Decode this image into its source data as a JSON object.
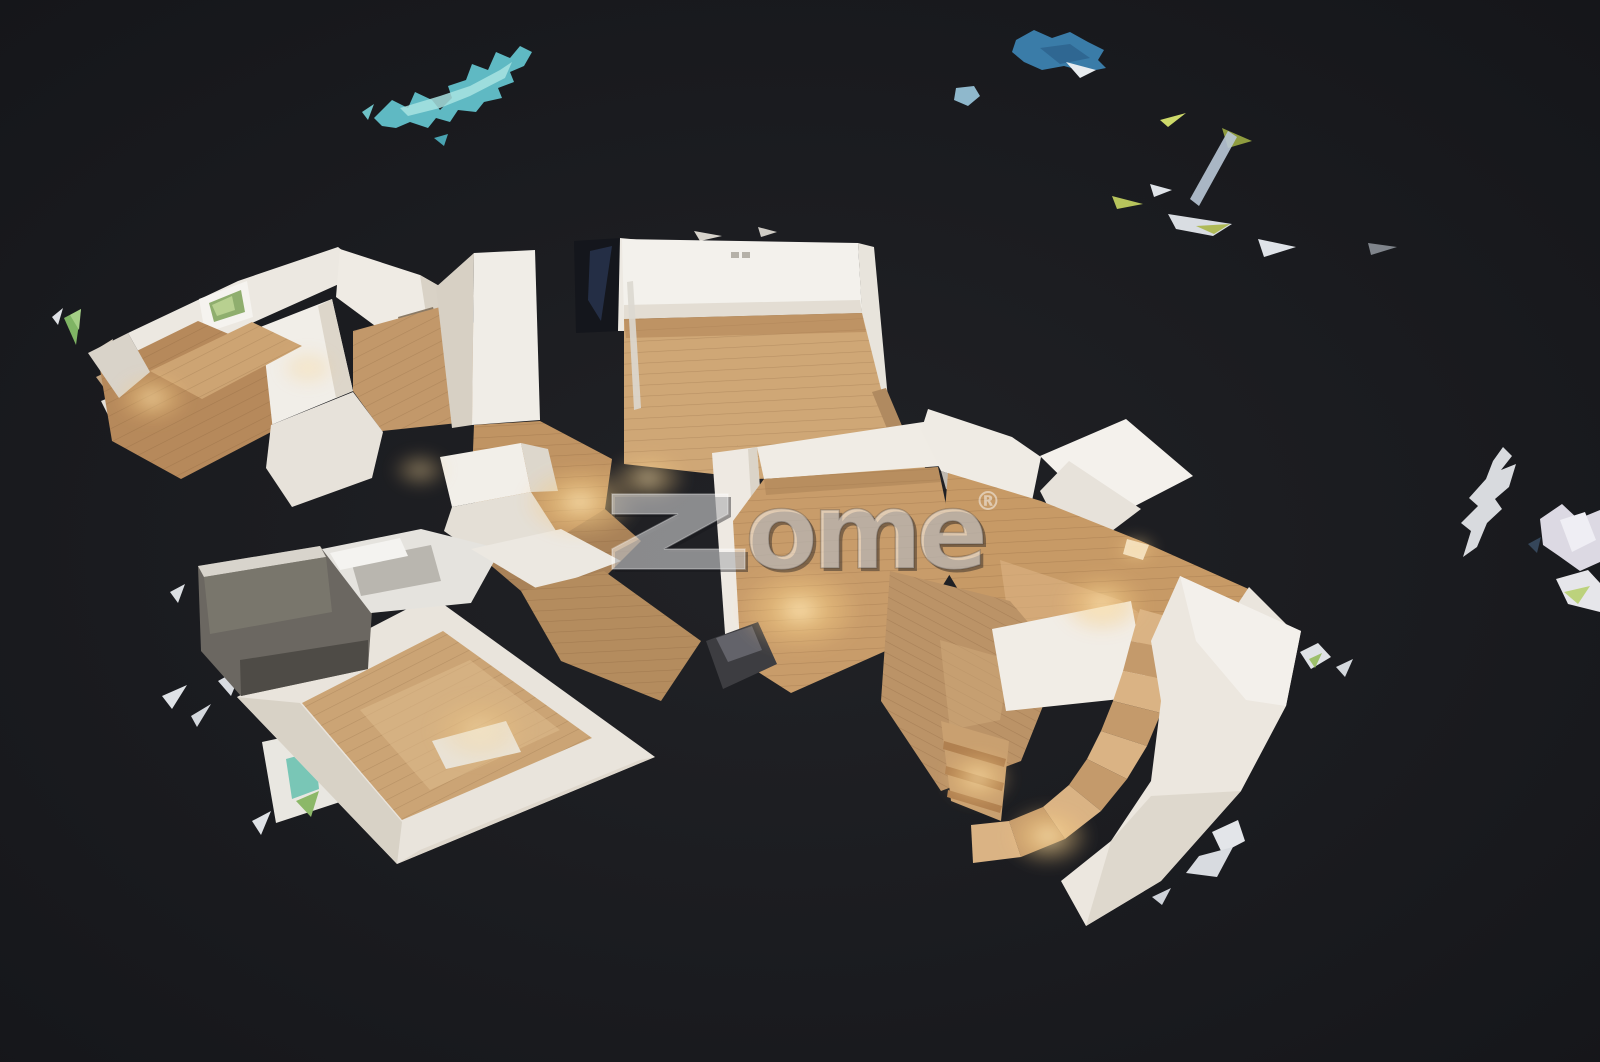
{
  "canvas": {
    "width": 1600,
    "height": 1062
  },
  "palette": {
    "background_center": "#212226",
    "background_edge": "#141519",
    "wall_light": "#f3f1ec",
    "wall": "#ece8e1",
    "wall_shade": "#d9d2c6",
    "wood_light": "#dcb688",
    "wood": "#c79e6c",
    "wood_dark": "#aa835a",
    "teal_fragment": "#5fb9c3",
    "blue_fragment": "#3a7ca8",
    "green_fragment": "#7fb464",
    "lamp_glow": "#ffe9b8",
    "watermark_fill": "rgba(250,250,250,0.5)",
    "watermark_shadow": "rgba(22,22,26,0.42)"
  },
  "watermark": {
    "brand": "zome®",
    "rest": "ome",
    "reg": "®",
    "z_points": "612,494 728,494 728,514 664,549 745,549 745,569 612,569 612,549 678,514 612,514"
  },
  "scene": {
    "shapes": [
      {
        "n": "teal-ceiling-fragment",
        "p": "374,118 392,100 408,108 415,92 432,100 440,110 452,98 448,86 466,80 472,64 488,70 496,52 510,58 520,46 532,52 524,66 510,72 514,82 498,88 502,98 484,102 476,112 458,110 450,122 436,118 428,128 410,122 396,128 382,126",
        "f": "#5fb9c3"
      },
      {
        "n": "teal-ceiling-fragment-highlight",
        "p": "400,108 440,96 470,86 500,70 512,62 505,78 470,96 440,108 408,116",
        "f": "#a8e3e2",
        "o": 0.85
      },
      {
        "n": "teal-fragment-dot",
        "p": "434,138 448,134 444,146",
        "f": "#4aa4b2"
      },
      {
        "n": "teal-fragment-sliver",
        "p": "362,112 374,104 368,120",
        "f": "#6fc2c8"
      },
      {
        "n": "blue-ceiling-fragment",
        "p": "1016,40 1034,30 1052,38 1070,32 1088,42 1104,50 1098,60 1106,68 1086,72 1064,66 1042,70 1024,62 1012,52",
        "f": "#3a7ca8"
      },
      {
        "n": "blue-ceiling-fragment-shade",
        "p": "1040,48 1070,44 1090,58 1060,64",
        "f": "#2d618c",
        "o": 0.8
      },
      {
        "n": "blue-fragment-white-corner",
        "p": "1066,62 1096,70 1080,78",
        "f": "#e8ecef"
      },
      {
        "n": "blue-fragment-small",
        "p": "956,88 974,86 980,96 968,106 954,100",
        "f": "#8fb8cc"
      },
      {
        "n": "shard-sliver",
        "p": "1160,120 1186,113 1168,127",
        "f": "#cdd96a"
      },
      {
        "n": "shard-sliver",
        "p": "1222,128 1252,141 1228,148",
        "f": "#8f9c3f"
      },
      {
        "n": "shard-sliver",
        "p": "1228,131 1237,137 1199,206 1190,199",
        "f": "#b9c8d6",
        "o": 0.9
      },
      {
        "n": "shard-sliver",
        "p": "1150,184 1172,190 1154,197",
        "f": "#dfe3e8"
      },
      {
        "n": "shard-sliver",
        "p": "1112,196 1143,204 1117,209",
        "f": "#b7c45c"
      },
      {
        "n": "shard-sliver",
        "p": "1168,214 1232,224 1213,236 1176,229",
        "f": "#d9dde2"
      },
      {
        "n": "shard-sliver",
        "p": "1196,226 1230,224 1214,234",
        "f": "#aab648",
        "o": 0.9
      },
      {
        "n": "shard-sliver",
        "p": "1258,239 1296,247 1264,257",
        "f": "#dfe3e8"
      },
      {
        "n": "shard-sliver",
        "p": "1368,243 1397,247 1371,255",
        "f": "#9aa0a8",
        "o": 0.8
      },
      {
        "n": "right-edge-shard",
        "p": "1493,461 1503,447 1512,456 1501,470 1516,464 1509,487 1495,499 1502,509 1487,523 1477,547 1463,557 1471,531 1461,523 1478,506 1469,498 1486,479",
        "f": "#d8dade"
      },
      {
        "n": "right-edge-shard",
        "p": "1540,519 1562,504 1578,519 1600,510 1600,562 1580,571 1559,556 1543,545",
        "f": "#dcd9e3"
      },
      {
        "n": "right-edge-shard-highlight",
        "p": "1560,520 1585,512 1596,540 1572,552",
        "f": "#efeef4"
      },
      {
        "n": "right-edge-shard",
        "p": "1556,579 1588,570 1600,583 1600,612 1568,604",
        "f": "#e6e6ea"
      },
      {
        "n": "right-edge-shard-green",
        "p": "1564,592 1590,586 1578,604",
        "f": "#bcd27c"
      },
      {
        "n": "right-edge-shard-dark",
        "p": "1528,544 1541,537 1537,553",
        "f": "#35465a"
      },
      {
        "n": "right-lower-shard",
        "p": "1300,652 1318,643 1331,657 1311,669",
        "f": "#dfe2e6"
      },
      {
        "n": "right-lower-shard-green",
        "p": "1309,659 1322,653 1315,668",
        "f": "#9cbf6a"
      },
      {
        "n": "right-lower-shard",
        "p": "1336,667 1353,659 1345,677",
        "f": "#d4d8dd"
      },
      {
        "n": "bottom-right-shard",
        "p": "1212,832 1238,820 1245,841 1222,853",
        "f": "#e3e5e9"
      },
      {
        "n": "bottom-right-shard",
        "p": "1199,856 1233,847 1217,877 1186,873",
        "f": "#d8dbe0"
      },
      {
        "n": "bottom-right-shard",
        "p": "1152,897 1171,888 1162,905",
        "f": "#cfd3d9"
      },
      {
        "n": "left-edge-shard-green",
        "p": "64,318 81,309 76,345",
        "f": "#7fb464"
      },
      {
        "n": "left-edge-shard-green-highlight",
        "p": "70,315 81,309 79,330",
        "f": "#a5cf86"
      },
      {
        "n": "left-edge-shard",
        "p": "52,317 63,308 58,325",
        "f": "#dfe2e6"
      },
      {
        "n": "left-edge-shard",
        "p": "92,352 113,339 106,369",
        "f": "#d9cdbd"
      },
      {
        "n": "left-edge-shard",
        "p": "96,377 119,366 108,393",
        "f": "#c2a37f"
      },
      {
        "n": "left-edge-shard",
        "p": "101,401 123,392 110,419",
        "f": "#e4e0d8"
      },
      {
        "n": "left-edge-shard",
        "p": "138,433 156,424 148,446",
        "f": "#cbb193"
      },
      {
        "n": "left-shard",
        "p": "170,592 185,584 178,603",
        "f": "#dcdfe3"
      },
      {
        "n": "left-shard",
        "p": "162,696 187,685 172,709",
        "f": "#dfe2e6"
      },
      {
        "n": "left-shard",
        "p": "191,716 211,704 197,727",
        "f": "#d4d8dd"
      },
      {
        "n": "left-shard",
        "p": "218,681 243,667 231,696",
        "f": "#d9dce1"
      },
      {
        "n": "mirror-fragment-frame",
        "p": "262,742 331,727 343,801 276,823",
        "f": "#e9e7e1"
      },
      {
        "n": "mirror-fragment-glass-teal",
        "p": "286,759 315,751 319,789 292,799",
        "f": "#79c6b6"
      },
      {
        "n": "mirror-fragment-glass-green",
        "p": "296,801 319,791 311,817",
        "f": "#8cb868"
      },
      {
        "n": "mirror-fragment-chip",
        "p": "252,821 271,811 261,835",
        "f": "#dfe2e6"
      },
      {
        "n": "bedroom-back-wall",
        "p": "128,333 238,281 338,247 368,271 252,323 150,372",
        "f": "#ece8e1"
      },
      {
        "n": "bedroom-window-frame",
        "p": "199,299 247,281 253,317 205,333",
        "f": "#f5f3ef"
      },
      {
        "n": "bedroom-window-glass",
        "p": "209,303 241,290 245,312 214,322",
        "f": "#8fae6e"
      },
      {
        "n": "bedroom-window-glass-highlight",
        "p": "212,305 232,296 235,310 217,316",
        "f": "#bcd494",
        "o": 0.9
      },
      {
        "n": "bedroom-right-wing-wall",
        "p": "340,249 420,275 462,299 458,349 382,331 336,297",
        "f": "#efebe4"
      },
      {
        "n": "bedroom-right-wing-shade",
        "p": "420,275 462,299 458,349 430,340",
        "f": "#d9d2c6"
      },
      {
        "n": "bedroom-mid-wall",
        "p": "250,331 332,299 353,391 271,425",
        "f": "#f1eee8"
      },
      {
        "n": "bedroom-mid-wall-shade",
        "p": "332,299 353,391 336,398 318,306",
        "f": "#ddd6ca"
      },
      {
        "n": "bedroom-floor-left",
        "p": "100,369 198,321 264,349 273,431 181,479 112,441",
        "f": "#b6895b",
        "pat": "pd2"
      },
      {
        "n": "bedroom-floor-strip",
        "p": "150,371 252,322 302,346 202,399",
        "f": "#cda473",
        "pat": "pd2"
      },
      {
        "n": "bedroom-door-dark",
        "p": "398,317 433,307 441,337 406,349",
        "f": "#8a7a66"
      },
      {
        "n": "bedroom-door-dark-inner",
        "p": "404,321 426,314 432,334 412,342",
        "f": "#5f5244"
      },
      {
        "n": "hall-floor-upper",
        "p": "353,331 462,301 487,349 477,421 382,431 353,391",
        "f": "#c2986a",
        "pat": "pd2"
      },
      {
        "n": "bedroom-lower-wall",
        "p": "271,425 353,392 383,432 372,478 292,507 266,468",
        "f": "#e7e2da"
      },
      {
        "n": "bedroom-outer-sliver",
        "p": "88,353 128,333 150,372 119,398",
        "f": "#d9d3c9"
      },
      {
        "n": "kitchen-left-wall-shade",
        "p": "436,287 474,253 472,425 452,428",
        "f": "#d7d0c4"
      },
      {
        "n": "kitchen-left-wall",
        "p": "474,253 535,250 540,420 472,425",
        "f": "#f0ede7"
      },
      {
        "n": "dark-doorway",
        "p": "574,241 622,238 620,331 576,333",
        "f": "#14161c"
      },
      {
        "n": "dark-doorway-stairs",
        "p": "590,251 612,246 601,321 588,300",
        "f": "#26314a",
        "o": 0.9
      },
      {
        "n": "doorway-right-jamb",
        "p": "620,238 641,240 639,331 618,331",
        "f": "#ede9e2"
      },
      {
        "n": "top-wall-sliver",
        "p": "694,231 722,236 700,241",
        "f": "#d8d4cc"
      },
      {
        "n": "top-wall-sliver",
        "p": "758,227 777,232 761,237",
        "f": "#cfccc5"
      },
      {
        "n": "living-room-top-wall",
        "p": "622,239 858,243 862,313 624,319",
        "f": "#f3f1ec"
      },
      {
        "n": "living-room-baseboard-shade",
        "p": "624,305 860,300 862,313 624,319",
        "f": "#ded8cd",
        "o": 0.8
      },
      {
        "n": "wall-socket",
        "p": "731,252 739,252 739,258 731,258",
        "f": "#b5b1a8"
      },
      {
        "n": "wall-socket",
        "p": "742,252 750,252 750,258 742,258",
        "f": "#b5b1a8"
      },
      {
        "n": "living-room-right-wall",
        "p": "858,243 874,247 890,421 868,425",
        "f": "#e8e4dc"
      },
      {
        "n": "living-room-floor",
        "p": "624,319 862,313 890,425 928,453 924,472 758,479 624,464",
        "f": "#cfa776",
        "pat": "ph"
      },
      {
        "n": "living-room-floor-shadow",
        "p": "624,319 862,313 866,332 626,338",
        "f": "#b08456",
        "o": 0.55
      },
      {
        "n": "glass-rail-pole",
        "p": "627,282 633,281 641,408 634,410",
        "f": "#dcd8d0",
        "o": 0.9
      },
      {
        "n": "plank-debris",
        "p": "872,392 886,388 908,440 895,448",
        "f": "#b08a60"
      },
      {
        "n": "kitchen-floor",
        "p": "474,425 540,421 612,459 605,509 560,541 471,501",
        "f": "#c09463",
        "pat": "ph"
      },
      {
        "n": "kitchen-counter-top",
        "p": "440,457 521,443 531,492 452,507",
        "f": "#f2efe9"
      },
      {
        "n": "kitchen-counter-side",
        "p": "521,443 548,449 558,491 531,492",
        "f": "#ddd7cc"
      },
      {
        "n": "kitchen-counter-front",
        "p": "452,507 531,492 560,537 481,557 444,531",
        "f": "#e4dfd6"
      },
      {
        "n": "kitchen-hall-floor",
        "p": "481,557 560,537 605,509 641,541 601,581 521,591",
        "f": "#a98258",
        "pat": "ph"
      },
      {
        "n": "center-room-left-wall",
        "p": "712,453 757,447 771,641 727,661",
        "f": "#eee9e2"
      },
      {
        "n": "center-room-left-wall-shade",
        "p": "757,447 771,641 760,646 748,449",
        "f": "#d8d1c5",
        "o": 0.9
      },
      {
        "n": "center-room-top-wall",
        "p": "757,447 930,421 941,466 764,479",
        "f": "#f0ece5"
      },
      {
        "n": "center-room-floor",
        "p": "764,479 938,467 958,561 908,641 791,693 741,661 733,521",
        "f": "#c89c6a",
        "pat": "ph"
      },
      {
        "n": "center-room-floor-shadow",
        "p": "764,479 938,467 941,482 766,495",
        "f": "#a87f53",
        "o": 0.5
      },
      {
        "n": "center-room-dark-mark",
        "p": "930,595 961,588 966,606 941,613",
        "f": "#27272c"
      },
      {
        "n": "right-room-wall-a",
        "p": "928,409 1012,437 1041,457 1032,501 941,471 921,431",
        "f": "#efebe4"
      },
      {
        "n": "right-room-wall-a-shade",
        "p": "941,471 1032,501 1028,517 946,489",
        "f": "#dcd5c9",
        "o": 0.85
      },
      {
        "n": "right-room-wall-b",
        "p": "1040,456 1126,419 1193,476 1106,521",
        "f": "#f4f1ec"
      },
      {
        "n": "right-room-wall-c",
        "p": "1040,491 1069,461 1141,509 1075,559",
        "f": "#e7e2da"
      },
      {
        "n": "right-room-floor",
        "p": "948,473 1041,501 1141,541 1253,591 1237,689 1121,673 1001,661 941,561",
        "f": "#c79a66",
        "pat": "ph"
      },
      {
        "n": "right-room-floor-highlight",
        "p": "1000,560 1120,600 1180,640 1100,660 1010,630",
        "f": "#dcb483",
        "o": 0.6
      },
      {
        "n": "right-room-right-wall",
        "p": "1249,587 1299,637 1233,701 1197,665",
        "f": "#eae5dd"
      },
      {
        "n": "right-room-right-wall-shade",
        "p": "1233,701 1197,665 1160,690 1190,722",
        "f": "#ddd6cb"
      },
      {
        "n": "ceiling-light-panel",
        "p": "1127,539 1149,545 1143,560 1123,554",
        "f": "#f6ead2",
        "o": 0.9
      },
      {
        "n": "stair-hall-floor",
        "p": "890,571 1010,601 1061,661 1021,761 941,791 881,701",
        "f": "#bb9367",
        "pat": "pd"
      },
      {
        "n": "stair-hall-floor-highlight",
        "p": "940,640 1010,660 1000,720 950,730",
        "f": "#d2ab7c",
        "o": 0.5
      },
      {
        "n": "stair-landing",
        "p": "992,629 1131,601 1149,696 1006,711",
        "f": "#f1ede6"
      },
      {
        "n": "stair-step",
        "p": "1140,609 1191,623 1181,651 1131,641",
        "f": "#dab384"
      },
      {
        "n": "stair-step",
        "p": "1131,641 1181,651 1173,681 1123,671",
        "f": "#c49a6b"
      },
      {
        "n": "stair-step",
        "p": "1123,671 1173,681 1161,713 1113,701",
        "f": "#dab384"
      },
      {
        "n": "stair-step",
        "p": "1113,701 1161,713 1147,746 1101,731",
        "f": "#c49a6b"
      },
      {
        "n": "stair-step",
        "p": "1101,731 1147,746 1127,779 1087,759",
        "f": "#dab384"
      },
      {
        "n": "stair-step",
        "p": "1087,759 1127,779 1101,811 1069,785",
        "f": "#c49a6b"
      },
      {
        "n": "stair-step",
        "p": "1069,785 1101,811 1065,839 1043,807",
        "f": "#dab384"
      },
      {
        "n": "stair-step",
        "p": "1043,807 1065,839 1021,857 1009,821",
        "f": "#c49a6b"
      },
      {
        "n": "stair-step",
        "p": "1009,821 1021,857 973,863 971,825",
        "f": "#dab384"
      },
      {
        "n": "stair-lower-steps",
        "p": "941,721 1009,741 1001,821 951,801",
        "f": "#c9a070"
      },
      {
        "n": "stair-lower-step-line",
        "p": "944,741 1006,759 1004,767 943,749",
        "f": "#b08050"
      },
      {
        "n": "stair-lower-step-line",
        "p": "946,766 1004,783 1002,791 945,774",
        "f": "#b08050"
      },
      {
        "n": "stair-lower-step-line",
        "p": "948,790 1002,806 1000,813 947,797",
        "f": "#b08050"
      },
      {
        "n": "stair-curved-wall",
        "p": "1180,576 1301,631 1286,706 1241,791 1161,881 1086,926 1061,881 1111,841 1151,781 1161,701 1151,641",
        "f": "#ece7df"
      },
      {
        "n": "stair-curved-wall-facet",
        "p": "1241,791 1161,881 1086,926 1111,841 1151,796",
        "f": "#ddd6cb",
        "o": 0.9
      },
      {
        "n": "stair-curved-wall-facet",
        "p": "1180,576 1301,631 1286,706 1246,700 1196,641",
        "f": "#f4f1ec",
        "o": 0.9
      },
      {
        "n": "lower-bedroom-walls",
        "p": "237,697 432,596 655,757 397,864",
        "f": "#e9e4dc"
      },
      {
        "n": "lower-bedroom-wall-shade-left",
        "p": "237,697 300,703 402,822 397,864",
        "f": "#d6cfc3",
        "o": 0.9
      },
      {
        "n": "lower-bedroom-wall-shade-bottom",
        "p": "420,850 640,760 655,757 397,864",
        "f": "#dcd5c9",
        "o": 0.8
      },
      {
        "n": "lower-bedroom-floor",
        "p": "302,703 443,631 592,738 402,820",
        "f": "#cba475",
        "pat": "pd2"
      },
      {
        "n": "lower-bedroom-floor-highlight",
        "p": "360,710 470,660 560,730 430,790",
        "f": "#debb8c",
        "o": 0.55
      },
      {
        "n": "lower-bedroom-rug",
        "p": "432,741 506,721 521,752 446,769",
        "f": "#e9e3d7"
      },
      {
        "n": "storage-box-dark",
        "p": "198,566 320,546 372,611 368,669 241,696 201,651",
        "f": "#6b6761"
      },
      {
        "n": "storage-box-front",
        "p": "240,660 368,640 368,669 241,696",
        "f": "#4e4b46"
      },
      {
        "n": "storage-box-top-edge",
        "p": "198,566 320,546 326,557 204,577",
        "f": "#d8d4cc"
      },
      {
        "n": "storage-box-mid",
        "p": "204,577 326,557 332,612 210,634",
        "f": "#7d7a6f",
        "o": 0.8
      },
      {
        "n": "bed-white",
        "p": "322,549 421,529 501,549 471,603 371,613",
        "f": "#e5e3de"
      },
      {
        "n": "bed-facet",
        "p": "351,561 431,545 441,581 361,596",
        "f": "#b9b6af"
      },
      {
        "n": "bed-highlight",
        "p": "330,553 400,538 408,556 340,570",
        "f": "#f4f3f0"
      },
      {
        "n": "connector-wall",
        "p": "471,549 561,529 621,561 541,591",
        "f": "#ece8e1"
      },
      {
        "n": "connector-floor",
        "p": "521,591 604,571 701,641 661,701 561,661",
        "f": "#b48c5e",
        "pat": "ph"
      },
      {
        "n": "dark-armchair",
        "p": "706,641 758,622 777,664 723,689",
        "f": "#3d3d41"
      },
      {
        "n": "dark-armchair-top",
        "p": "716,638 752,626 762,650 728,662",
        "f": "#63636a"
      }
    ],
    "glows": [
      {
        "cx": 152,
        "cy": 398,
        "rx": 38,
        "ry": 26,
        "o": 0.75
      },
      {
        "cx": 308,
        "cy": 368,
        "rx": 30,
        "ry": 20,
        "o": 0.5
      },
      {
        "cx": 420,
        "cy": 470,
        "rx": 30,
        "ry": 20,
        "o": 0.5
      },
      {
        "cx": 580,
        "cy": 502,
        "rx": 60,
        "ry": 38,
        "o": 0.9
      },
      {
        "cx": 648,
        "cy": 478,
        "rx": 40,
        "ry": 26,
        "o": 0.7
      },
      {
        "cx": 800,
        "cy": 610,
        "rx": 64,
        "ry": 44,
        "o": 0.95
      },
      {
        "cx": 1102,
        "cy": 604,
        "rx": 46,
        "ry": 32,
        "o": 0.85
      },
      {
        "cx": 1136,
        "cy": 549,
        "rx": 22,
        "ry": 14,
        "o": 0.7
      },
      {
        "cx": 978,
        "cy": 778,
        "rx": 36,
        "ry": 28,
        "o": 0.8
      },
      {
        "cx": 1048,
        "cy": 836,
        "rx": 44,
        "ry": 32,
        "o": 0.85
      },
      {
        "cx": 480,
        "cy": 730,
        "rx": 52,
        "ry": 36,
        "o": 0.5
      }
    ]
  }
}
